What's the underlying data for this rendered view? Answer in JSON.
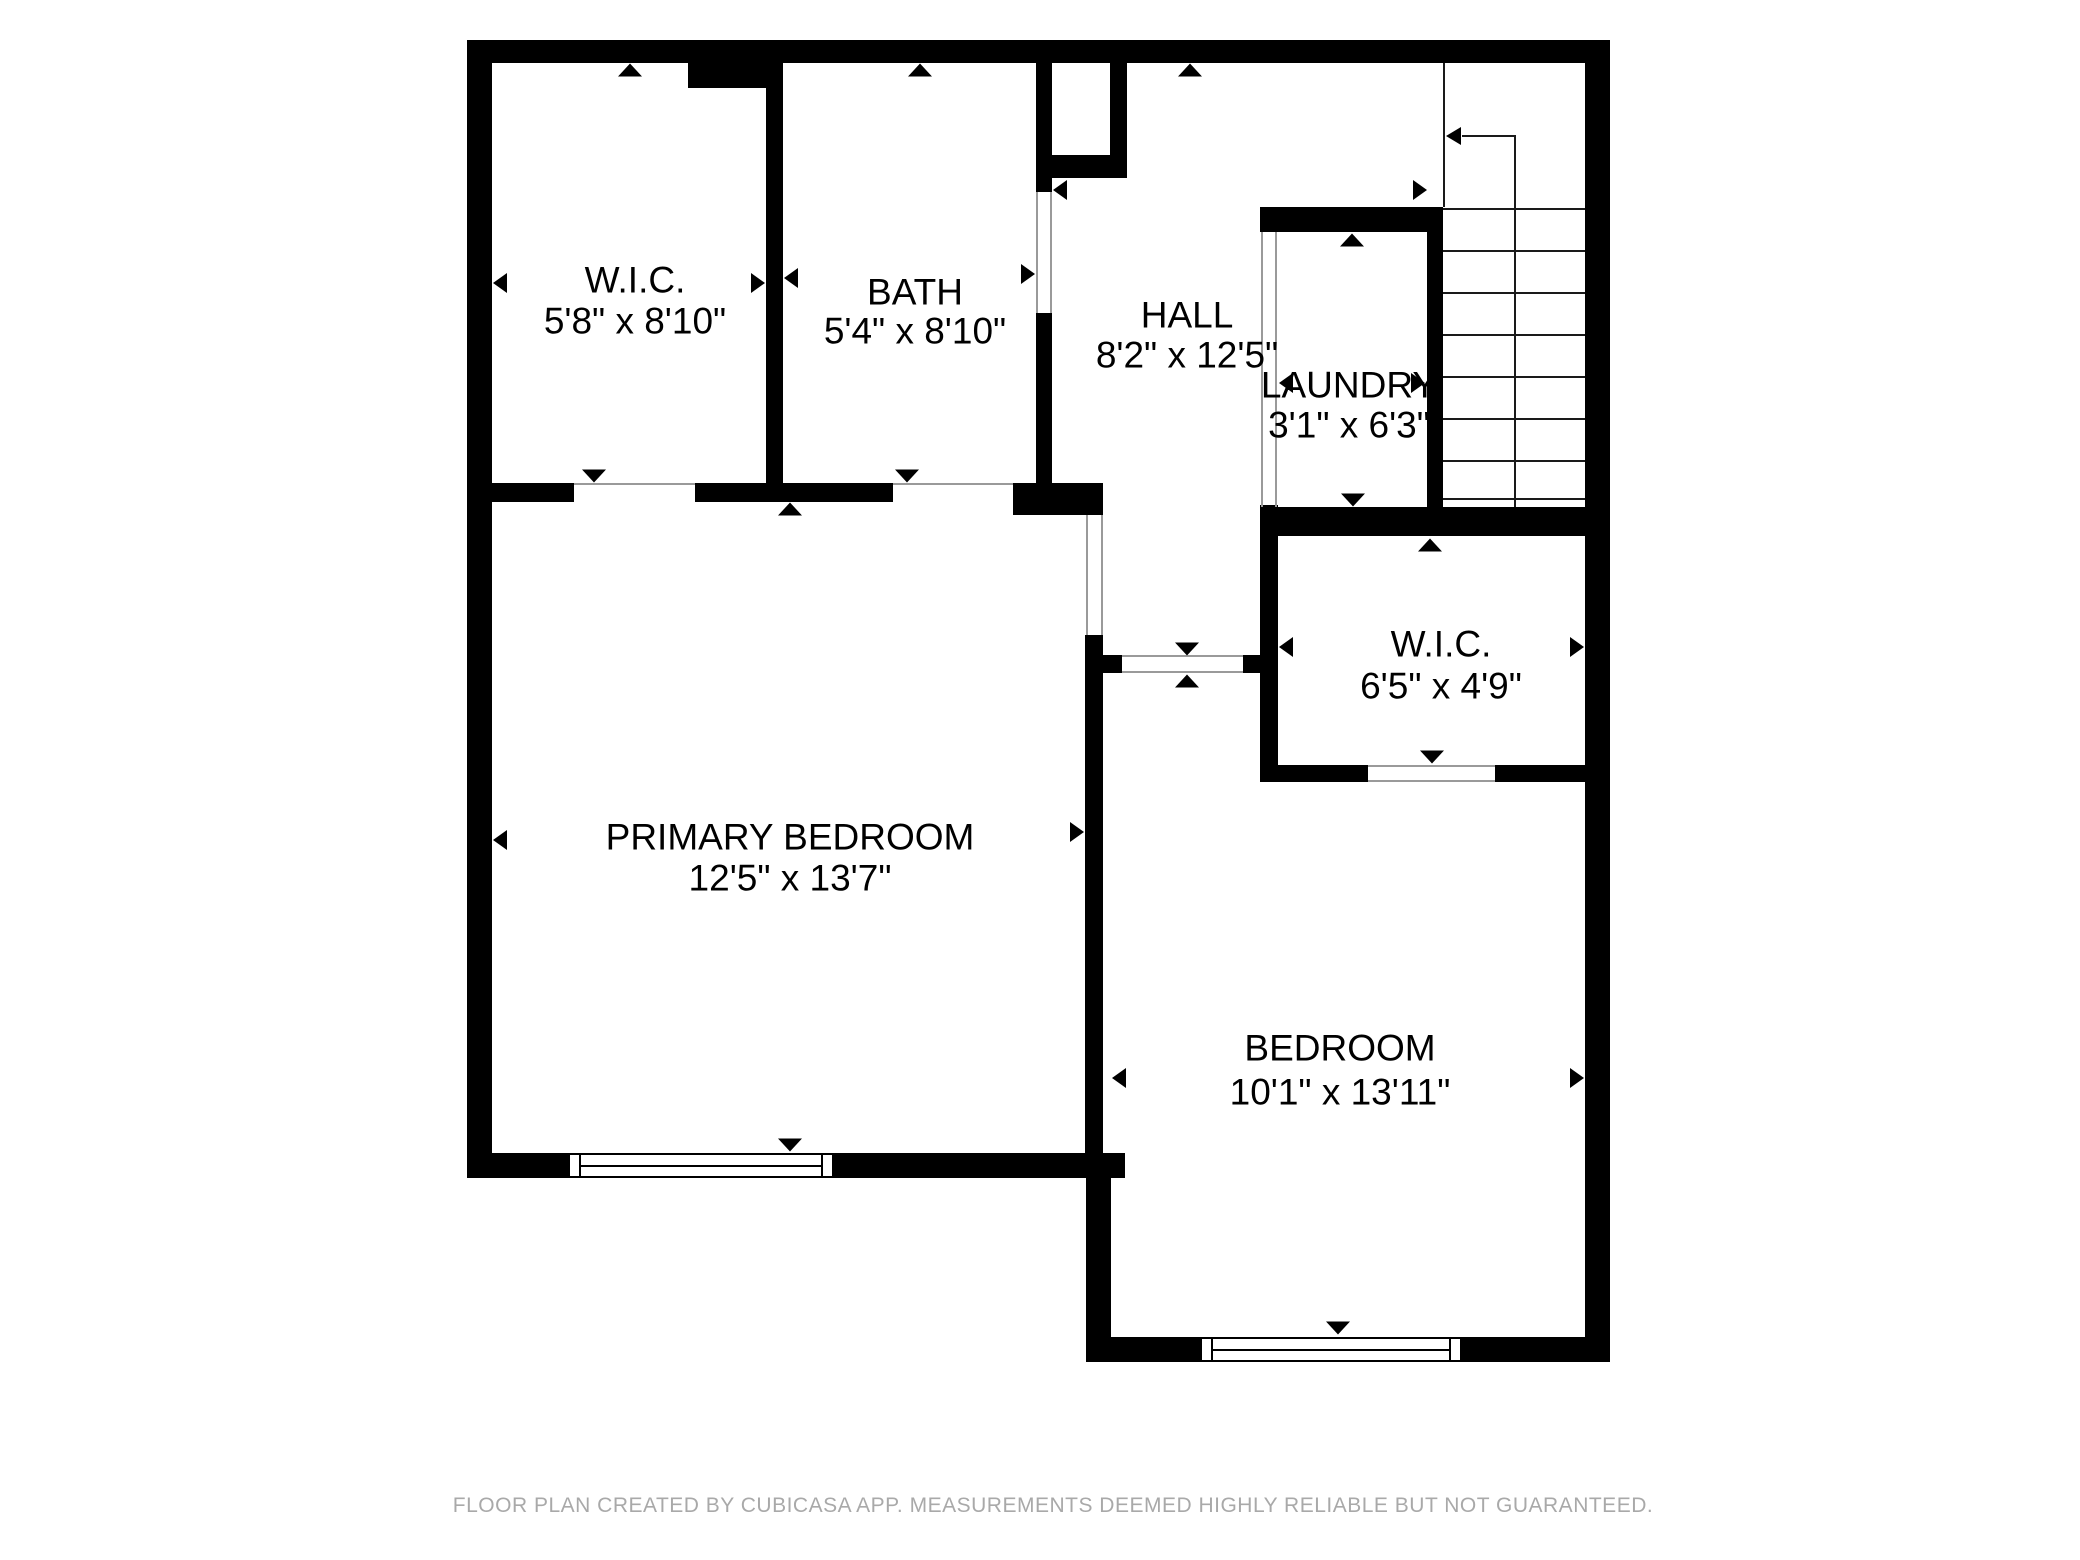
{
  "colors": {
    "wall": "#000000",
    "footer_text": "#a9a9a9",
    "label_text": "#000000"
  },
  "footer": {
    "text": "FLOOR PLAN CREATED BY CUBICASA APP. MEASUREMENTS DEEMED HIGHLY RELIABLE BUT NOT GUARANTEED.",
    "x": 1053,
    "y": 1494
  },
  "rooms": [
    {
      "id": "wic-upper",
      "name": "W.I.C.",
      "dims": "5'8\" x 8'10\"",
      "x": 635,
      "y1": 280,
      "y2": 321
    },
    {
      "id": "bath",
      "name": "BATH",
      "dims": "5'4\" x 8'10\"",
      "x": 915,
      "y1": 292,
      "y2": 331
    },
    {
      "id": "hall",
      "name": "HALL",
      "dims": "8'2\" x 12'5\"",
      "x": 1187,
      "y1": 315,
      "y2": 355
    },
    {
      "id": "laundry",
      "name": "LAUNDRY",
      "dims": "3'1\" x 6'3\"",
      "x": 1349,
      "y1": 385,
      "y2": 425
    },
    {
      "id": "wic-lower",
      "name": "W.I.C.",
      "dims": "6'5\" x 4'9\"",
      "x": 1441,
      "y1": 644,
      "y2": 686
    },
    {
      "id": "primary-bedroom",
      "name": "PRIMARY BEDROOM",
      "dims": "12'5\" x 13'7\"",
      "x": 790,
      "y1": 837,
      "y2": 878
    },
    {
      "id": "bedroom",
      "name": "BEDROOM",
      "dims": "10'1\" x 13'11\"",
      "x": 1340,
      "y1": 1048,
      "y2": 1092
    }
  ],
  "walls": [
    {
      "x": 467,
      "y": 40,
      "w": 1143,
      "h": 23,
      "part": "exterior-top"
    },
    {
      "x": 467,
      "y": 40,
      "w": 25,
      "h": 1138,
      "part": "exterior-left"
    },
    {
      "x": 1585,
      "y": 40,
      "w": 25,
      "h": 1322,
      "part": "exterior-right"
    },
    {
      "x": 467,
      "y": 1153,
      "w": 101,
      "h": 25,
      "part": "primary-bottom-left"
    },
    {
      "x": 834,
      "y": 1153,
      "w": 291,
      "h": 25,
      "part": "primary-bottom-right"
    },
    {
      "x": 1086,
      "y": 1178,
      "w": 25,
      "h": 184,
      "part": "bedroom-lower-left"
    },
    {
      "x": 1086,
      "y": 1337,
      "w": 114,
      "h": 25,
      "part": "bedroom-bottom-left"
    },
    {
      "x": 1462,
      "y": 1337,
      "w": 148,
      "h": 25,
      "part": "bedroom-bottom-right"
    },
    {
      "x": 688,
      "y": 63,
      "w": 93,
      "h": 25,
      "part": "wic-top-notch"
    },
    {
      "x": 766,
      "y": 63,
      "w": 17,
      "h": 420,
      "part": "wic-bath-divider"
    },
    {
      "x": 492,
      "y": 483,
      "w": 82,
      "h": 19,
      "part": "wic-bottom"
    },
    {
      "x": 695,
      "y": 483,
      "w": 198,
      "h": 19,
      "part": "bath-bottom"
    },
    {
      "x": 1013,
      "y": 483,
      "w": 90,
      "h": 32,
      "part": "bath-bottom-corner"
    },
    {
      "x": 1036,
      "y": 63,
      "w": 16,
      "h": 129,
      "part": "bath-right-upper"
    },
    {
      "x": 1036,
      "y": 313,
      "w": 16,
      "h": 170,
      "part": "bath-right-lower"
    },
    {
      "x": 1050,
      "y": 155,
      "w": 77,
      "h": 23,
      "part": "niche-bottom"
    },
    {
      "x": 1110,
      "y": 63,
      "w": 17,
      "h": 92,
      "part": "niche-right"
    },
    {
      "x": 1085,
      "y": 635,
      "w": 18,
      "h": 543,
      "part": "primary-bedroom-divider"
    },
    {
      "x": 1103,
      "y": 655,
      "w": 19,
      "h": 18,
      "part": "bedroom-door-stub-left"
    },
    {
      "x": 1243,
      "y": 655,
      "w": 17,
      "h": 18,
      "part": "bedroom-door-stub-right"
    },
    {
      "x": 1260,
      "y": 505,
      "w": 18,
      "h": 277,
      "part": "wic-lower-left"
    },
    {
      "x": 1260,
      "y": 207,
      "w": 183,
      "h": 25,
      "part": "laundry-top"
    },
    {
      "x": 1427,
      "y": 207,
      "w": 16,
      "h": 300,
      "part": "stairs-left"
    },
    {
      "x": 1260,
      "y": 507,
      "w": 325,
      "h": 29,
      "part": "laundry-bottom-wic-top"
    },
    {
      "x": 1260,
      "y": 765,
      "w": 108,
      "h": 17,
      "part": "wic-lower-bottom-left"
    },
    {
      "x": 1495,
      "y": 765,
      "w": 90,
      "h": 17,
      "part": "wic-lower-bottom-right"
    }
  ],
  "opening_lines": [
    {
      "x": 574,
      "y": 483,
      "w": 121,
      "h": 2,
      "at": "wic-door"
    },
    {
      "x": 893,
      "y": 483,
      "w": 120,
      "h": 2,
      "at": "bath-primary-door"
    },
    {
      "x": 1036,
      "y": 192,
      "w": 2,
      "h": 121,
      "at": "bath-hall-door-left"
    },
    {
      "x": 1050,
      "y": 192,
      "w": 2,
      "h": 121,
      "at": "bath-hall-door-right"
    },
    {
      "x": 1086,
      "y": 515,
      "w": 2,
      "h": 120,
      "at": "primary-hall-door-left"
    },
    {
      "x": 1101,
      "y": 515,
      "w": 2,
      "h": 120,
      "at": "primary-hall-door-right"
    },
    {
      "x": 1122,
      "y": 655,
      "w": 121,
      "h": 2,
      "at": "bedroom-door-top"
    },
    {
      "x": 1122,
      "y": 671,
      "w": 121,
      "h": 2,
      "at": "bedroom-door-bottom"
    },
    {
      "x": 1368,
      "y": 765,
      "w": 127,
      "h": 2,
      "at": "wic-lower-door-top"
    },
    {
      "x": 1368,
      "y": 780,
      "w": 127,
      "h": 2,
      "at": "wic-lower-door-bottom"
    },
    {
      "x": 1261,
      "y": 232,
      "w": 2,
      "h": 275,
      "at": "laundry-opening-left"
    },
    {
      "x": 1275,
      "y": 232,
      "w": 2,
      "h": 275,
      "at": "laundry-opening-right"
    }
  ],
  "windows": [
    {
      "x": 568,
      "y": 1153,
      "w": 266,
      "h": 25,
      "at": "primary-bedroom"
    },
    {
      "x": 1200,
      "y": 1337,
      "w": 262,
      "h": 25,
      "at": "bedroom"
    }
  ],
  "dimension_arrows": [
    {
      "x": 630,
      "y": 70,
      "dir": "up",
      "room": "wic-upper"
    },
    {
      "x": 594,
      "y": 476,
      "dir": "down",
      "room": "wic-upper"
    },
    {
      "x": 500,
      "y": 283,
      "dir": "left",
      "room": "wic-upper"
    },
    {
      "x": 758,
      "y": 283,
      "dir": "right",
      "room": "wic-upper"
    },
    {
      "x": 920,
      "y": 70,
      "dir": "up",
      "room": "bath"
    },
    {
      "x": 907,
      "y": 476,
      "dir": "down",
      "room": "bath"
    },
    {
      "x": 791,
      "y": 278,
      "dir": "left",
      "room": "bath"
    },
    {
      "x": 1028,
      "y": 274,
      "dir": "right",
      "room": "bath"
    },
    {
      "x": 1190,
      "y": 70,
      "dir": "up",
      "room": "hall"
    },
    {
      "x": 1187,
      "y": 649,
      "dir": "down",
      "room": "hall"
    },
    {
      "x": 1060,
      "y": 190,
      "dir": "left",
      "room": "hall"
    },
    {
      "x": 1420,
      "y": 190,
      "dir": "right",
      "room": "hall"
    },
    {
      "x": 1352,
      "y": 240,
      "dir": "up",
      "room": "laundry"
    },
    {
      "x": 1353,
      "y": 500,
      "dir": "down",
      "room": "laundry"
    },
    {
      "x": 1286,
      "y": 383,
      "dir": "left",
      "room": "laundry"
    },
    {
      "x": 1418,
      "y": 383,
      "dir": "right",
      "room": "laundry"
    },
    {
      "x": 1430,
      "y": 545,
      "dir": "up",
      "room": "wic-lower"
    },
    {
      "x": 1432,
      "y": 757,
      "dir": "down",
      "room": "wic-lower"
    },
    {
      "x": 1286,
      "y": 647,
      "dir": "left",
      "room": "wic-lower"
    },
    {
      "x": 1577,
      "y": 647,
      "dir": "right",
      "room": "wic-lower"
    },
    {
      "x": 790,
      "y": 509,
      "dir": "up",
      "room": "primary-bedroom"
    },
    {
      "x": 790,
      "y": 1145,
      "dir": "down",
      "room": "primary-bedroom"
    },
    {
      "x": 500,
      "y": 840,
      "dir": "left",
      "room": "primary-bedroom"
    },
    {
      "x": 1077,
      "y": 832,
      "dir": "right",
      "room": "primary-bedroom"
    },
    {
      "x": 1187,
      "y": 681,
      "dir": "up",
      "room": "bedroom"
    },
    {
      "x": 1338,
      "y": 1328,
      "dir": "down",
      "room": "bedroom"
    },
    {
      "x": 1119,
      "y": 1078,
      "dir": "left",
      "room": "bedroom"
    },
    {
      "x": 1577,
      "y": 1078,
      "dir": "right",
      "room": "bedroom"
    }
  ],
  "stairs": {
    "x": 1443,
    "y": 63,
    "w": 142,
    "h": 444,
    "treads_y": [
      208,
      250,
      292,
      334,
      376,
      418,
      460,
      498
    ],
    "mid_line": {
      "x": 1514,
      "y1": 136,
      "y2": 507
    },
    "left_line": {
      "x": 1443,
      "y1": 63,
      "y2": 207
    },
    "arrow": {
      "line_x1": 1462,
      "line_x2": 1516,
      "y": 136,
      "head_x": 1448
    }
  }
}
